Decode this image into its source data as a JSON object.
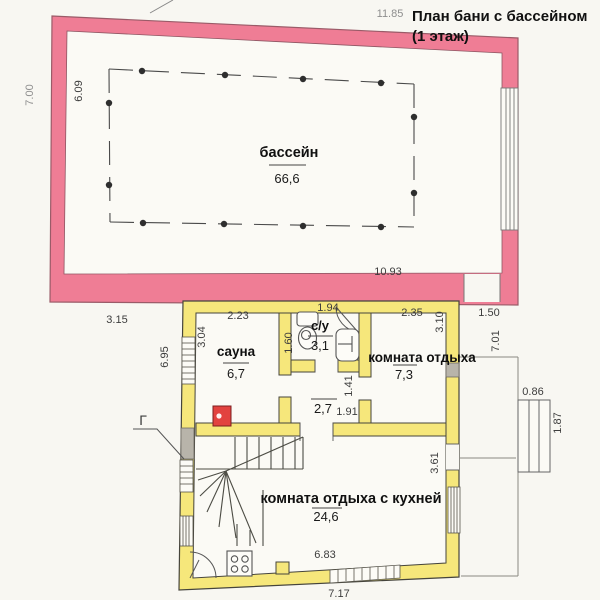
{
  "title": {
    "line1": "План бани с бассейном",
    "line2": "(1 этаж)"
  },
  "rooms": {
    "pool_hall": {
      "name": "бассейн",
      "area": "66,6"
    },
    "sauna": {
      "name": "сауна",
      "area": "6,7"
    },
    "wc": {
      "name": "с/у",
      "area": "3,1"
    },
    "rest_room": {
      "name": "комната отдыха",
      "area": "7,3"
    },
    "hallway": {
      "area": "2,7"
    },
    "rest_room_kitchen": {
      "name": "комната отдыха с кухней",
      "area": "24,6"
    }
  },
  "annotations": {
    "gas_label": "Г"
  },
  "dimensions": {
    "top_width": "11.85",
    "left_height": "7.00",
    "pool_inner_height": "6.09",
    "pool_inner_width": "10.93",
    "gap_left": "3.15",
    "pool_door_width": "1.50",
    "porch_height": "7.01",
    "steps_width": "0.86",
    "steps_depth": "1.87",
    "sauna_width": "2.23",
    "sauna_height": "3.04",
    "house_left_wall": "6.95",
    "wc_width": "1.94",
    "wc_height": "1.60",
    "rest_width": "2.35",
    "rest_height": "3.10",
    "hall_height": "1.41",
    "hall_width": "1.91",
    "kitchen_right": "3.61",
    "kitchen_bottom": "6.83",
    "house_bottom_width": "7.17"
  },
  "colors": {
    "pool_wall": "#ef7d95",
    "house_wall": "#f6e77b",
    "stove": "#e2423f",
    "paper": "#f8f7f2",
    "floor": "#fbfaf5",
    "gray_panel": "#b8b4aa"
  }
}
